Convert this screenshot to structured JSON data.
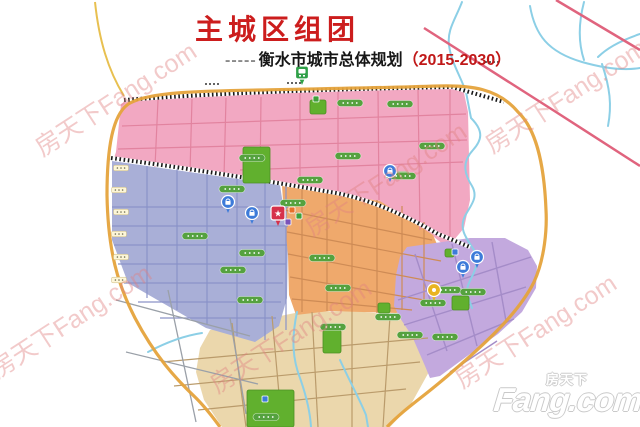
{
  "header": {
    "title": "主城区组团",
    "subtitle_prefix": "-----",
    "subtitle": "衡水市城市总体规划",
    "subtitle_years": "（2015-2030）"
  },
  "watermark": {
    "text": "房天下Fang.com",
    "color": "rgba(224,128,128,0.42)",
    "angle_deg": -33,
    "positions": [
      [
        115,
        98
      ],
      [
        565,
        95
      ],
      [
        385,
        178
      ],
      [
        70,
        320
      ],
      [
        290,
        335
      ],
      [
        535,
        330
      ]
    ]
  },
  "logo": {
    "cn": "房天下",
    "en": "Fang.com"
  },
  "map": {
    "colors": {
      "pink": "#F2A8C2",
      "blue": "#A9AFD7",
      "orange": "#EFA96C",
      "purple": "#C3A9DE",
      "tan": "#EBD7AC",
      "park": "#61B02E",
      "park_border": "#4C8F24",
      "boundary": "#E5A33C",
      "river": "#8CCFE6",
      "railway": "#1A1A1A",
      "pink_road": "#E2839F",
      "blue_road": "#8A92C8",
      "orange_road": "#CE8B55",
      "purple_road": "#A48CC8",
      "tan_road": "#BA9B6B",
      "gray_road": "#9AA0A8",
      "outer_road_pink": "#E0647E",
      "outer_road_yellow": "#E8C050",
      "label_green": "#55A23F",
      "label_light": "#FDF6D8",
      "pin_blue": "#3D7BD9",
      "pin_gold": "#E9B421",
      "pin_red": "#D6304A",
      "pin_station_green": "#2FA048"
    },
    "region_names": [
      "north-pink-district",
      "west-blue-district",
      "central-orange-district",
      "east-purple-district",
      "south-tan-district"
    ],
    "parks": [
      [
        243,
        147,
        27,
        36
      ],
      [
        310,
        100,
        16,
        14
      ],
      [
        323,
        330,
        18,
        23
      ],
      [
        247,
        390,
        47,
        37
      ],
      [
        452,
        296,
        17,
        14
      ],
      [
        445,
        249,
        9,
        8
      ],
      [
        378,
        303,
        12,
        10
      ]
    ],
    "pins": {
      "blue_circle": [
        [
          228,
          202
        ],
        [
          252,
          213
        ],
        [
          390,
          171
        ],
        [
          463,
          267
        ],
        [
          477,
          257
        ]
      ],
      "gold_circle": [
        [
          434,
          290
        ]
      ],
      "star": [
        [
          278,
          214
        ]
      ],
      "station": [
        [
          302,
          73
        ]
      ],
      "small_squares": [
        [
          292,
          210,
          "#E8702A"
        ],
        [
          299,
          216,
          "#3FA03A"
        ],
        [
          288,
          222,
          "#7A52B8"
        ],
        [
          455,
          252,
          "#3D7BD9"
        ],
        [
          316,
          99,
          "#3FA03A"
        ],
        [
          265,
          399,
          "#3D7BD9"
        ]
      ]
    },
    "labels": {
      "green": [
        [
          350,
          103
        ],
        [
          400,
          104
        ],
        [
          348,
          156
        ],
        [
          398,
          175
        ],
        [
          432,
          146
        ],
        [
          310,
          180
        ],
        [
          232,
          189
        ],
        [
          195,
          236
        ],
        [
          252,
          253
        ],
        [
          233,
          270
        ],
        [
          250,
          300
        ],
        [
          293,
          203
        ],
        [
          322,
          258
        ],
        [
          338,
          288
        ],
        [
          410,
          335
        ],
        [
          445,
          337
        ],
        [
          448,
          290
        ],
        [
          473,
          292
        ],
        [
          333,
          327
        ],
        [
          388,
          317
        ],
        [
          403,
          176
        ],
        [
          433,
          303
        ],
        [
          266,
          417
        ],
        [
          252,
          158
        ]
      ],
      "light": [
        [
          121,
          168
        ],
        [
          119,
          190
        ],
        [
          121,
          212
        ],
        [
          119,
          234
        ],
        [
          121,
          257
        ],
        [
          119,
          280
        ]
      ],
      "dark": [
        [
          212,
          84
        ],
        [
          294,
          83
        ],
        [
          492,
          62
        ]
      ]
    }
  }
}
